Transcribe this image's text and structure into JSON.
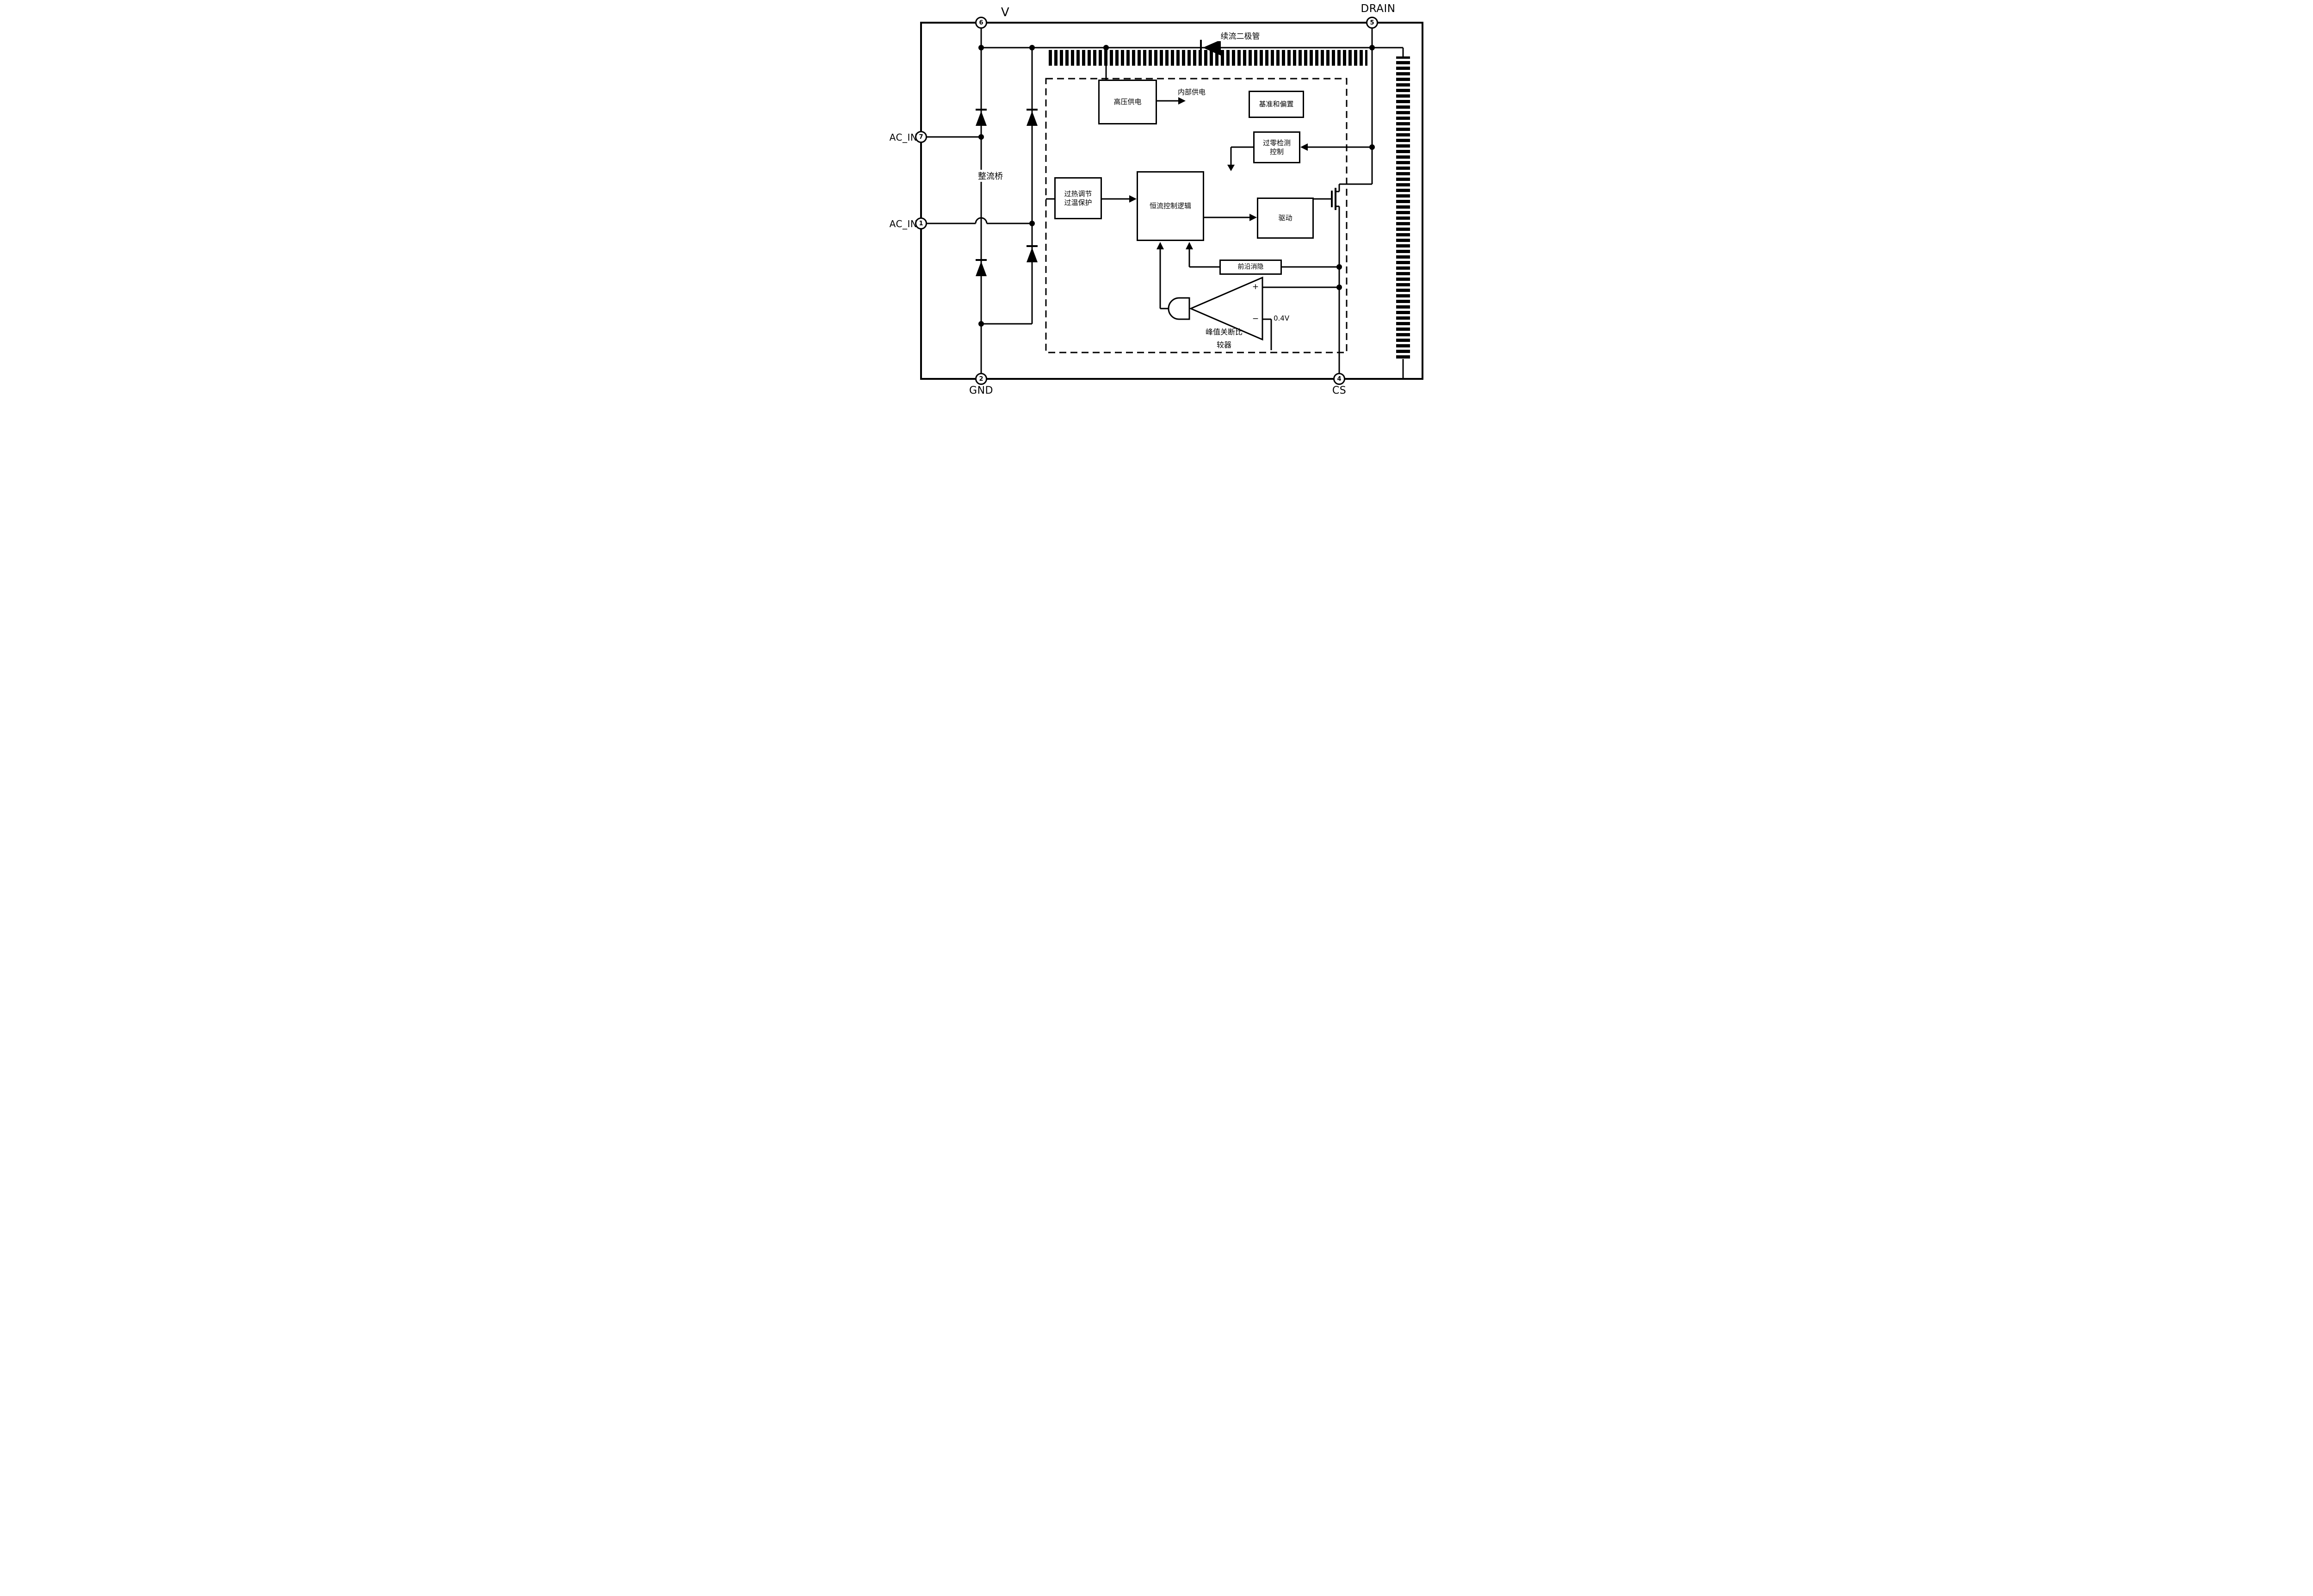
{
  "diagram": {
    "kind": "led-driver-ic-block-diagram",
    "colors": {
      "line": "#000000",
      "background": "#ffffff"
    }
  },
  "pins": [
    {
      "id": "v",
      "name": "V",
      "number": "6"
    },
    {
      "id": "drain",
      "name": "DRAIN",
      "number": "5"
    },
    {
      "id": "ac-top",
      "name": "AC_IN",
      "number": "7"
    },
    {
      "id": "ac-bot",
      "name": "AC_IN",
      "number": "1"
    },
    {
      "id": "gnd",
      "name": "GND",
      "number": "2"
    },
    {
      "id": "cs",
      "name": "CS",
      "number": "4"
    }
  ],
  "blocks": [
    {
      "id": "hv",
      "label": "高压供电"
    },
    {
      "id": "ref",
      "label": "基准和偏置"
    },
    {
      "id": "zcd",
      "line1": "过零检测",
      "line2": "控制"
    },
    {
      "id": "otp",
      "line1": "过热调节",
      "line2": "过温保护"
    },
    {
      "id": "cc",
      "label": "恒流控制逻辑"
    },
    {
      "id": "drv",
      "label": "驱动"
    },
    {
      "id": "leb",
      "label": "前沿消隐"
    }
  ],
  "labels": {
    "rectifier_bridge": "整流桥",
    "freewheel_diode": "续流二极管",
    "internal_supply": "内部供电",
    "comparator_line1": "峰值关断比",
    "comparator_line2": "较器",
    "comparator_plus": "+",
    "comparator_minus": "−",
    "reference_voltage": "0.4V"
  }
}
